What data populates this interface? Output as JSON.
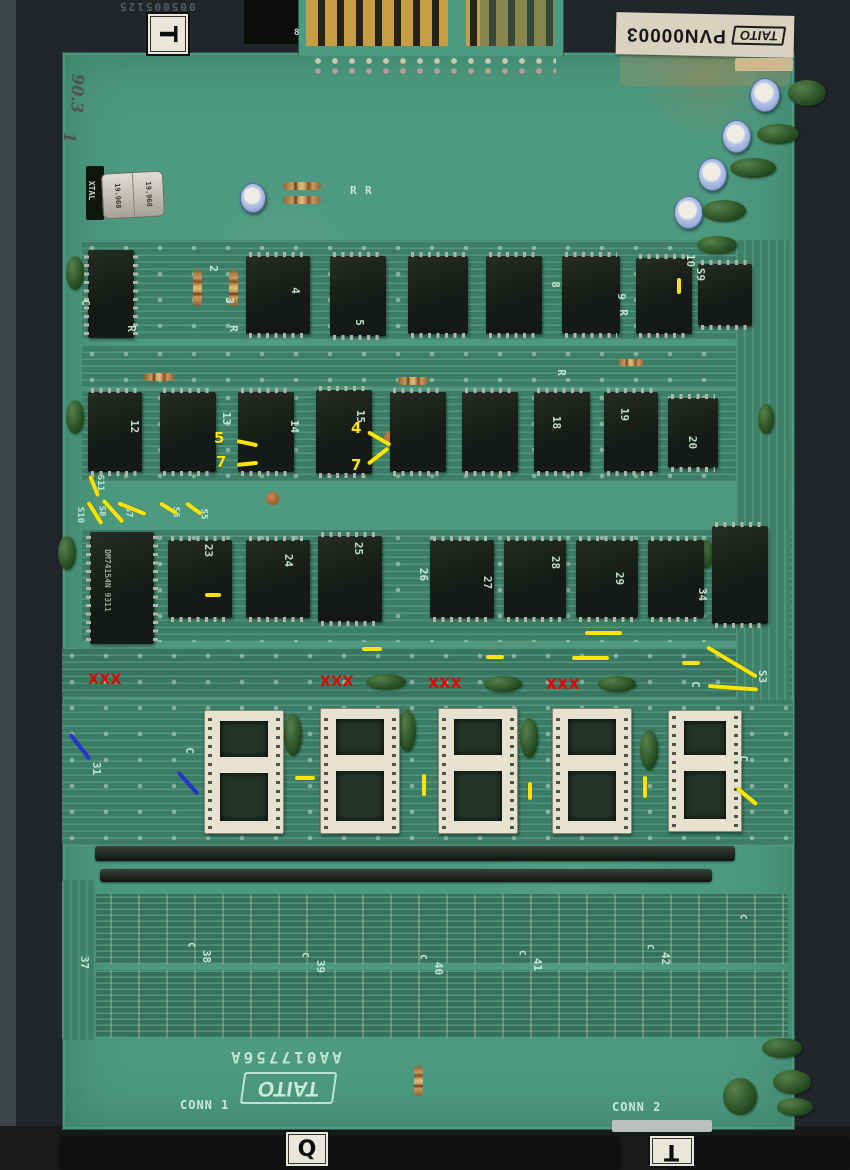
{
  "meta": {
    "description": "Scanned photograph of a Taito arcade printed circuit board with repair annotations",
    "board_color": "#4d9a80",
    "annotation_yellow": "#ffe400",
    "annotation_red": "#e60000",
    "annotation_blue": "#2633cc"
  },
  "labels": {
    "top_sticker": {
      "brand": "TAITO",
      "part_no": "PVN00003"
    },
    "bottom_silk": {
      "brand": "TAITO",
      "part_no": "AA017756A"
    },
    "conn1": "CONN 1",
    "conn2": "CONN 2",
    "handwritten": "90.3",
    "handwritten2": "1",
    "faint_edge_text": "005005125",
    "xtal_silk": "XTAL",
    "xtal_freq_l": "19.968",
    "xtal_freq_r": "19.968",
    "big_chip_line1": "DM74154N",
    "big_chip_line2": "9311",
    "marker_top": "T",
    "marker_bottom_left": "Q",
    "marker_bottom_right": "T",
    "tab_mark": "8"
  },
  "silkscreen": {
    "row1": [
      "2",
      "3",
      "4",
      "5",
      "8",
      "9",
      "10"
    ],
    "row2": [
      "12",
      "13",
      "14",
      "15",
      "18",
      "19",
      "20"
    ],
    "row3": [
      "23",
      "24",
      "25",
      "26",
      "27",
      "28",
      "29",
      "34"
    ],
    "bottom": [
      "37",
      "38",
      "39",
      "40",
      "41",
      "42"
    ],
    "jumpers": [
      "S11",
      "S10",
      "S8",
      "S7",
      "S6",
      "S5"
    ],
    "s9": "S9",
    "s3": "S3",
    "socket_row_ref": "31",
    "r": "R",
    "c": "C"
  },
  "annotations": {
    "xxx": "XXX",
    "num_5": "5",
    "num_7a": "7",
    "num_4": "4",
    "num_7b": "7"
  }
}
